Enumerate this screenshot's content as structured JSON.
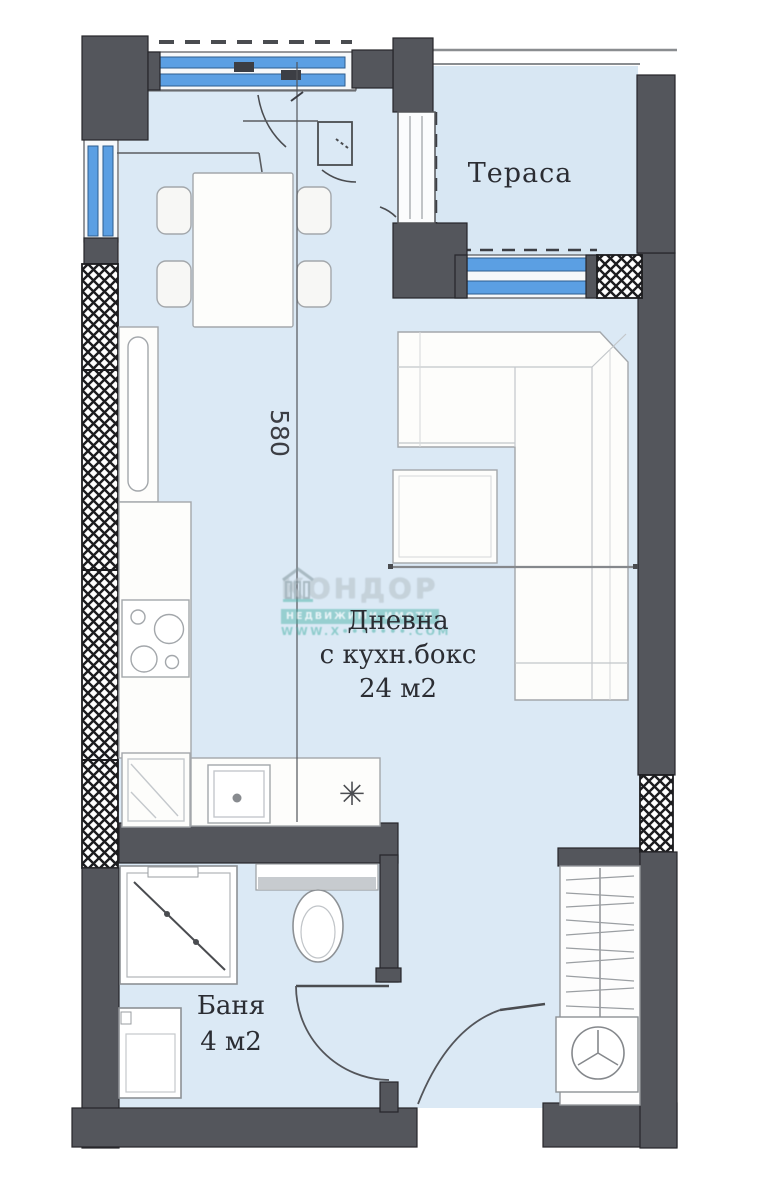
{
  "plan_title": "apartment-floor-plan",
  "rooms": {
    "terrace": {
      "label": "Тераса"
    },
    "living": {
      "line1": "Дневна",
      "line2": "с кухн.бокс",
      "line3": "24 м2"
    },
    "bathroom": {
      "line1": "Баня",
      "line2": "4 м2"
    }
  },
  "dimensions": {
    "living_width": "580"
  },
  "watermark": {
    "brand": "КОНДОР",
    "tagline": "НЕДВИЖИМИ ИМОТИ",
    "url": "WWW.X•••••••.COM"
  },
  "icons": {
    "fridge_symbol": "✳"
  },
  "colors": {
    "wall": "#54565c",
    "wall_outline": "#26262a",
    "floor": "#dbe9f5",
    "glass": "#5b9fe3",
    "furniture_outline": "#a3a7ab",
    "watermark_teal": "#49b2a7"
  }
}
